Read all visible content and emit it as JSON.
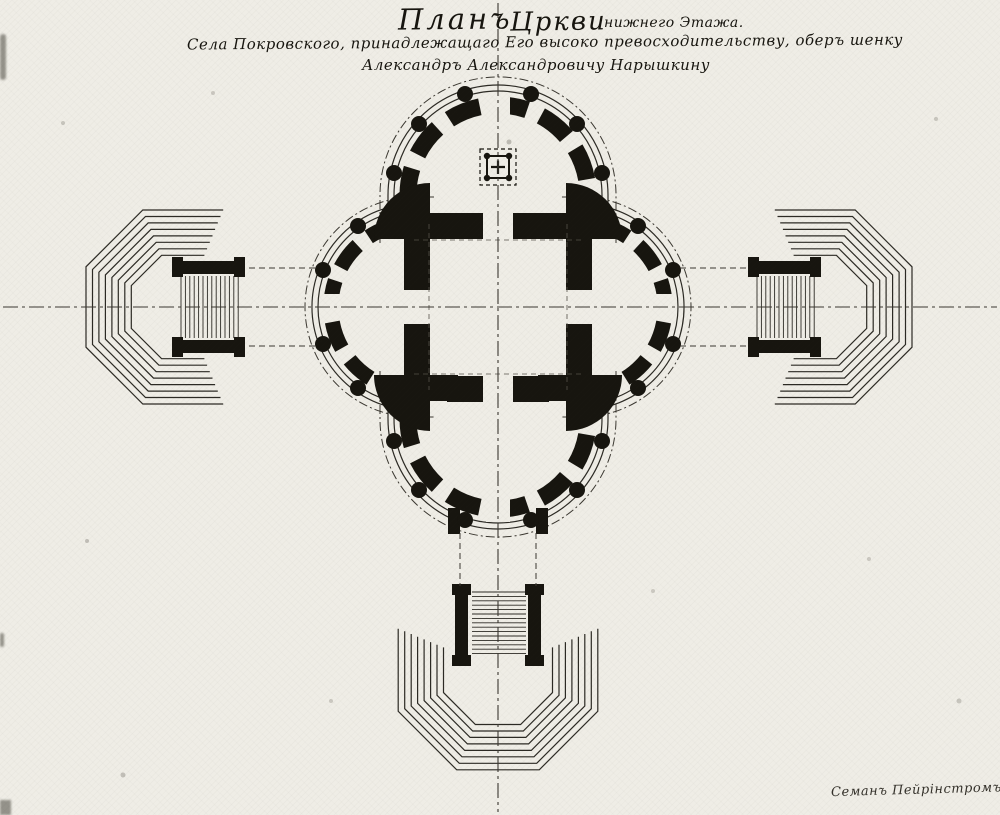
{
  "title": {
    "word1": "Планъ",
    "word2": "Цркви",
    "word3": "нижнего Этажа.",
    "line2": "Села Покровского, принадлежащаго Его высоко превосходительству, оберъ шенку",
    "line3": "Александръ Александровичу Нарышкину"
  },
  "signature": {
    "text": "Семанъ Пейрінстромъ Архит"
  },
  "colors": {
    "paper": "#efede6",
    "ink": "#17150f",
    "line": "#2c2a24",
    "centerline": "#3b3831"
  }
}
